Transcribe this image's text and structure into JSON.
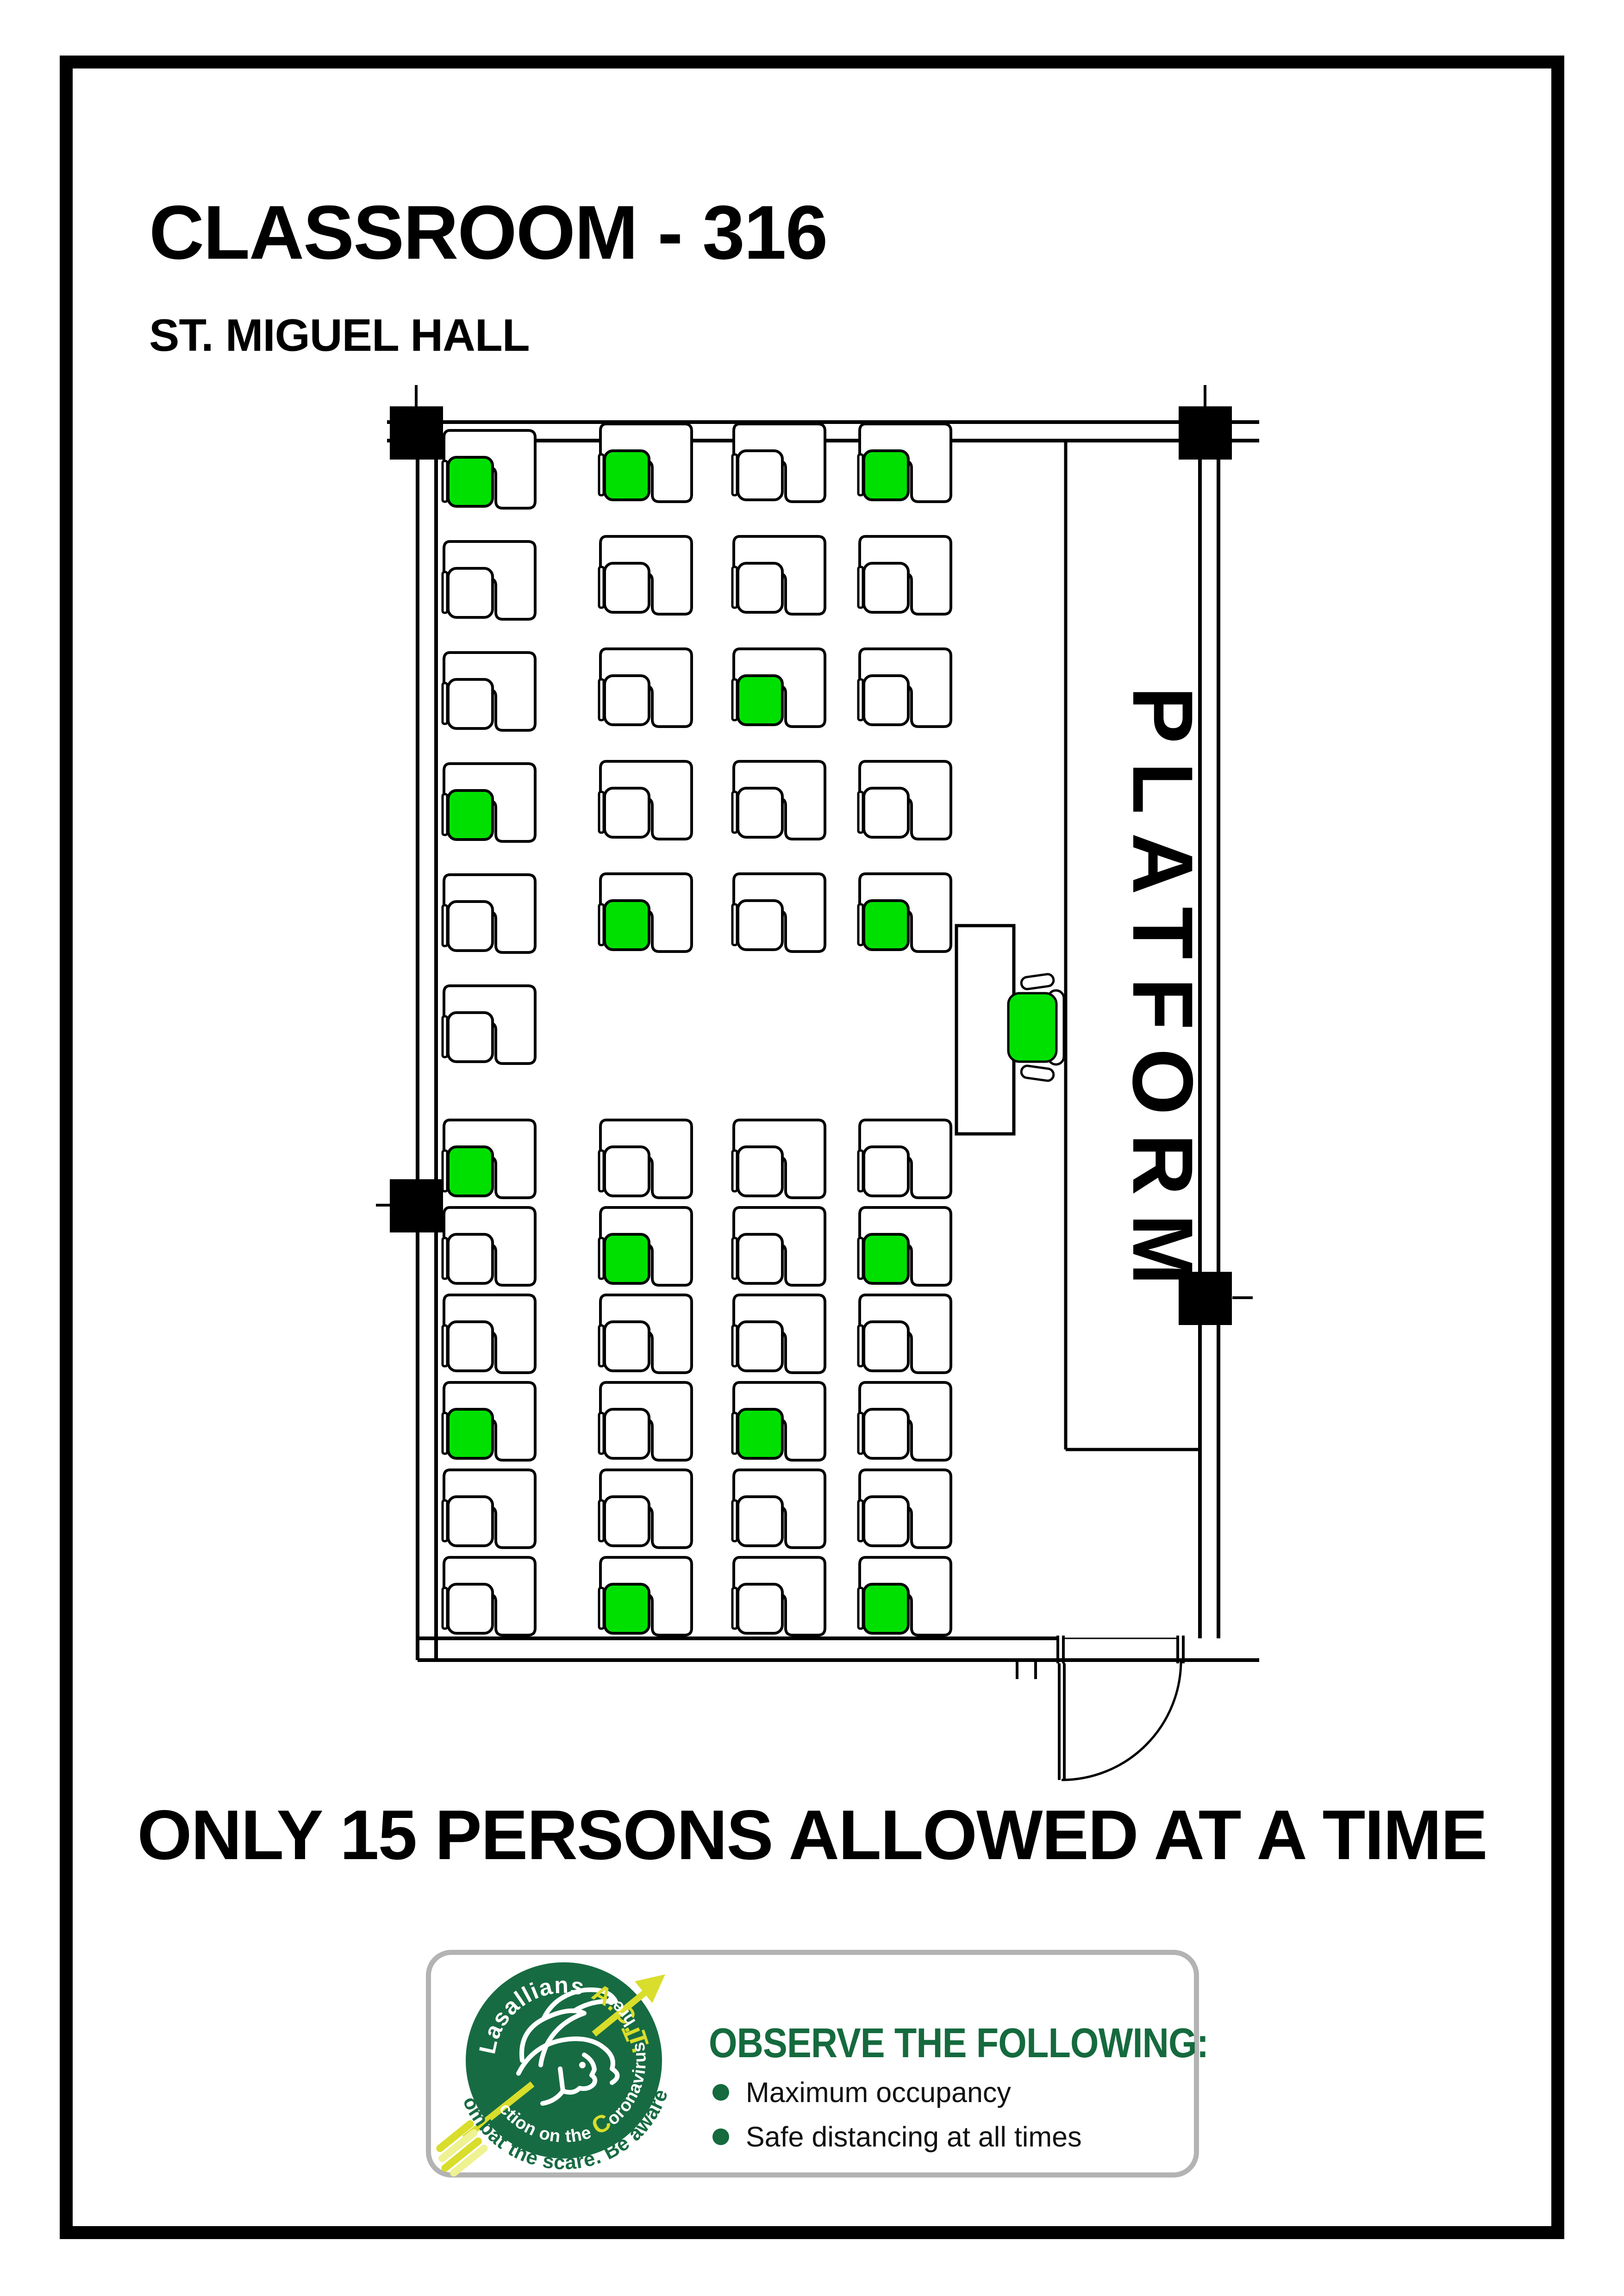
{
  "page": {
    "title": "CLASSROOM - 316",
    "subtitle": "ST. MIGUEL HALL",
    "capacity_notice": "ONLY 15 PERSONS ALLOWED AT A TIME"
  },
  "plan": {
    "platform_label": "PLATFORM",
    "colors": {
      "seat_available": "#00E000",
      "seat_empty": "#FFFFFF",
      "line": "#000000"
    },
    "top_section": {
      "wall_column_seats": [
        "available",
        "empty",
        "empty",
        "available",
        "empty",
        "empty"
      ],
      "columns": [
        {
          "seats": [
            "available",
            "empty",
            "empty",
            "empty",
            "available"
          ]
        },
        {
          "seats": [
            "empty",
            "empty",
            "available",
            "empty",
            "empty"
          ]
        },
        {
          "seats": [
            "available",
            "empty",
            "empty",
            "empty",
            "available"
          ]
        }
      ]
    },
    "bottom_section": {
      "rows": [
        [
          "available",
          "empty",
          "empty",
          "empty"
        ],
        [
          "empty",
          "available",
          "empty",
          "available"
        ],
        [
          "empty",
          "empty",
          "empty",
          "empty"
        ],
        [
          "available",
          "empty",
          "available",
          "empty"
        ],
        [
          "empty",
          "empty",
          "empty",
          "empty"
        ],
        [
          "empty",
          "available",
          "empty",
          "available"
        ]
      ]
    },
    "teacher_seat": "available"
  },
  "footer_card": {
    "heading": "OBSERVE THE FOLLOWING:",
    "bullets": [
      "Maximum occupancy",
      "Safe distancing at all times"
    ],
    "logo": {
      "arc_top_parts": [
        {
          "text": "Lasallians ",
          "accent": false
        },
        {
          "text": "A.C.T.",
          "accent": true
        }
      ],
      "arc_side_parts": [
        {
          "text": "A",
          "accent": true
        },
        {
          "text": "ction on the ",
          "accent": false
        },
        {
          "text": "C",
          "accent": true
        },
        {
          "text": "oronavirus ",
          "accent": false
        },
        {
          "text": "T",
          "accent": true
        },
        {
          "text": "hreat",
          "accent": false
        }
      ],
      "arc_bottom": "Combat the scare. Be aware.",
      "colors": {
        "circle": "#176B42",
        "accent": "#D9DD2B",
        "text": "#FFFFFF",
        "tagline": "#176B42"
      }
    }
  }
}
